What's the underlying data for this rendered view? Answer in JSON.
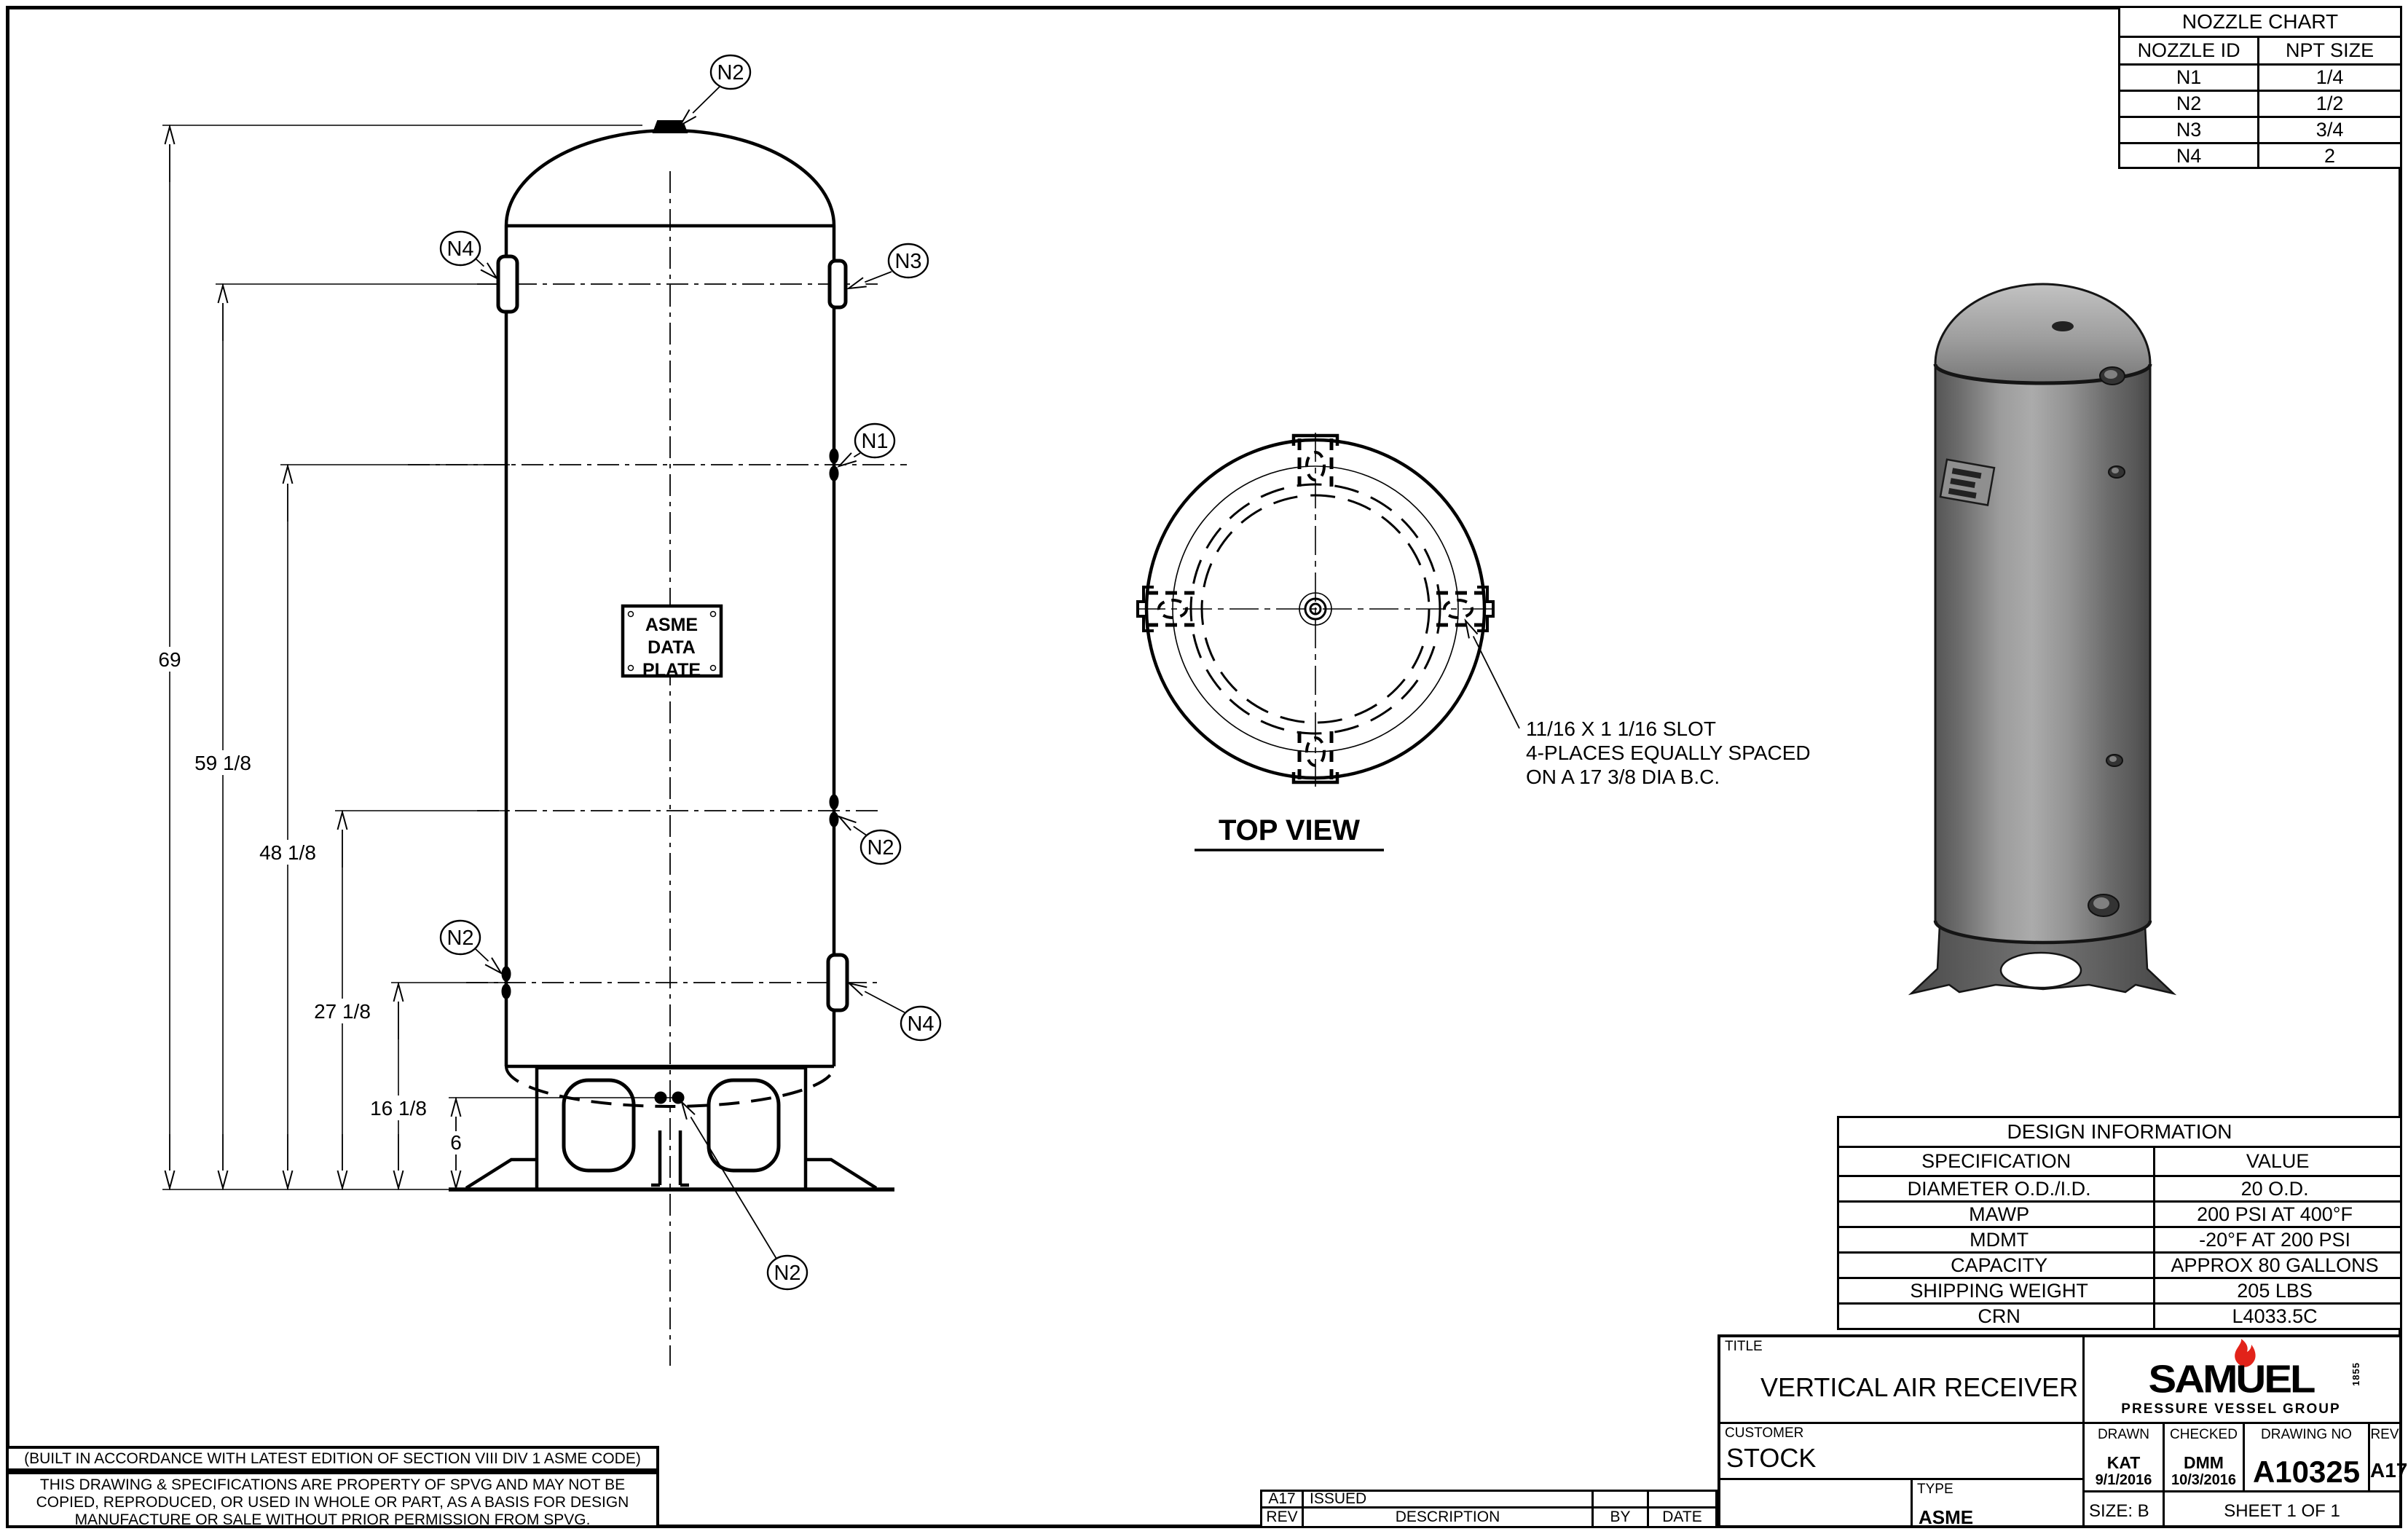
{
  "nozzle_chart": {
    "title": "NOZZLE CHART",
    "col1": "NOZZLE ID",
    "col2": "NPT SIZE",
    "rows": [
      {
        "id": "N1",
        "size": "1/4"
      },
      {
        "id": "N2",
        "size": "1/2"
      },
      {
        "id": "N3",
        "size": "3/4"
      },
      {
        "id": "N4",
        "size": "2"
      }
    ]
  },
  "design_information": {
    "title": "DESIGN INFORMATION",
    "col1": "SPECIFICATION",
    "col2": "VALUE",
    "rows": [
      {
        "spec": "DIAMETER O.D./I.D.",
        "value": "20 O.D."
      },
      {
        "spec": "MAWP",
        "value": "200 PSI AT 400°F"
      },
      {
        "spec": "MDMT",
        "value": "-20°F AT 200 PSI"
      },
      {
        "spec": "CAPACITY",
        "value": "APPROX 80 GALLONS"
      },
      {
        "spec": "SHIPPING WEIGHT",
        "value": "205 LBS"
      },
      {
        "spec": "CRN",
        "value": "L4033.5C"
      }
    ]
  },
  "title_block": {
    "title_label": "TITLE",
    "title": "VERTICAL AIR RECEIVER",
    "customer_label": "CUSTOMER",
    "customer": "STOCK",
    "type_label": "TYPE",
    "type": "ASME",
    "drawn_label": "DRAWN",
    "drawn_by": "KAT",
    "drawn_date": "9/1/2016",
    "checked_label": "CHECKED",
    "checked_by": "DMM",
    "checked_date": "10/3/2016",
    "drawing_no_label": "DRAWING NO",
    "drawing_no": "A10325",
    "rev_label": "REV",
    "rev": "A17",
    "size": "SIZE: B",
    "sheet": "SHEET 1  OF 1"
  },
  "logo": {
    "brand": "SAMUEL",
    "est": "1855",
    "tagline": "PRESSURE VESSEL GROUP"
  },
  "revision_table": {
    "rev": "A17",
    "description": "ISSUED",
    "by": "",
    "date": "",
    "header_rev": "REV",
    "header_description": "DESCRIPTION",
    "header_by": "BY",
    "header_date": "DATE"
  },
  "notes": {
    "code_note": "(BUILT IN ACCORDANCE WITH LATEST EDITION OF SECTION VIII DIV 1 ASME CODE)",
    "property_line1": "THIS DRAWING & SPECIFICATIONS ARE PROPERTY OF SPVG AND MAY NOT BE",
    "property_line2": "COPIED, REPRODUCED, OR USED IN WHOLE OR PART, AS A BASIS FOR DESIGN",
    "property_line3": "MANUFACTURE OR SALE WITHOUT PRIOR PERMISSION FROM SPVG."
  },
  "front_view": {
    "dims": {
      "overall": "69",
      "n4_n3": "59 1/8",
      "n1": "48 1/8",
      "n2_upper": "27 1/8",
      "n2_lower": "16 1/8",
      "drain": "6"
    },
    "data_plate": {
      "line1": "ASME",
      "line2": "DATA",
      "line3": "PLATE"
    },
    "callouts": {
      "top": "N2",
      "upper_left": "N4",
      "upper_right": "N3",
      "right_n1": "N1",
      "right_n2": "N2",
      "left_n2": "N2",
      "lower_right_n4": "N4",
      "bottom": "N2"
    }
  },
  "top_view": {
    "label": "TOP VIEW",
    "slot_note_line1": "11/16 X 1 1/16 SLOT",
    "slot_note_line2": "4-PLACES EQUALLY SPACED",
    "slot_note_line3": "ON A 17 3/8 DIA B.C."
  },
  "colors": {
    "line": "#000000",
    "flame_red": "#e2231a",
    "render_body_mid": "#9c9c9c",
    "render_body_dark": "#4f4f4f",
    "render_dome_light": "#c2c2c2"
  }
}
